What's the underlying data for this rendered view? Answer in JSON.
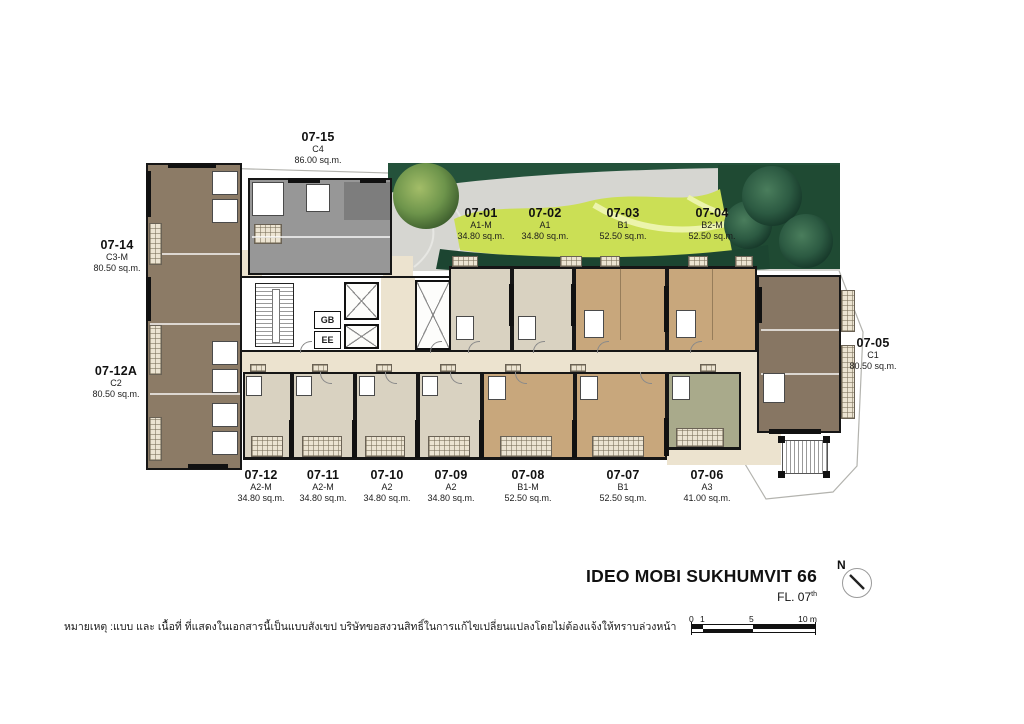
{
  "project": {
    "name": "IDEO MOBI SUKHUMVIT 66",
    "floor_label": "FL. 07",
    "floor_sup": "th"
  },
  "north_label": "N",
  "disclaimer": "หมายเหตุ :แบบ และ เนื้อที่ ที่แสดงในเอกสารนี้เป็นแบบสังเขป บริษัทขอสงวนสิทธิ์ในการแก้ไขเปลี่ยนแปลงโดยไม่ต้องแจ้งให้ทราบล่วงหน้า",
  "scale": {
    "labels": [
      "0",
      "1",
      "5",
      "10 m"
    ]
  },
  "core": {
    "gb": "GB",
    "ee": "EE"
  },
  "units": [
    {
      "id": "07-15",
      "type": "C4",
      "area": "86.00 sq.m."
    },
    {
      "id": "07-14",
      "type": "C3-M",
      "area": "80.50 sq.m."
    },
    {
      "id": "07-12A",
      "type": "C2",
      "area": "80.50 sq.m."
    },
    {
      "id": "07-01",
      "type": "A1-M",
      "area": "34.80 sq.m."
    },
    {
      "id": "07-02",
      "type": "A1",
      "area": "34.80 sq.m."
    },
    {
      "id": "07-03",
      "type": "B1",
      "area": "52.50 sq.m."
    },
    {
      "id": "07-04",
      "type": "B2-M",
      "area": "52.50 sq.m."
    },
    {
      "id": "07-05",
      "type": "C1",
      "area": "80.50 sq.m."
    },
    {
      "id": "07-12",
      "type": "A2-M",
      "area": "34.80 sq.m."
    },
    {
      "id": "07-11",
      "type": "A2-M",
      "area": "34.80 sq.m."
    },
    {
      "id": "07-10",
      "type": "A2",
      "area": "34.80 sq.m."
    },
    {
      "id": "07-09",
      "type": "A2",
      "area": "34.80 sq.m."
    },
    {
      "id": "07-08",
      "type": "B1-M",
      "area": "52.50 sq.m."
    },
    {
      "id": "07-07",
      "type": "B1",
      "area": "52.50 sq.m."
    },
    {
      "id": "07-06",
      "type": "A3",
      "area": "41.00 sq.m."
    }
  ],
  "colors": {
    "brown": "#8c7b66",
    "beige": "#d9d2c1",
    "tan": "#c8a77c",
    "olive": "#a9aa8b",
    "dark_taupe": "#877663",
    "gray_unit": "#979797",
    "gray_dark": "#7d7d7d",
    "cream": "#ece3cf",
    "balcony": "#ece4d2",
    "lawn": "#cbdf55",
    "lawn_light": "#ecf4ac",
    "hedge": "#20503a",
    "paver": "#d6d6d1",
    "wall": "#161616"
  }
}
